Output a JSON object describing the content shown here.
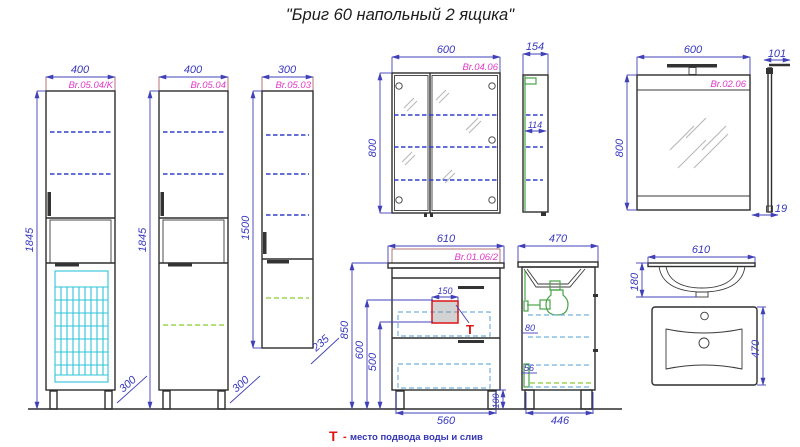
{
  "title": "\"Бриг 60 напольный 2 ящика\"",
  "legend": {
    "symbol": "Т",
    "dash": "-",
    "text": "место подвода воды и слив"
  },
  "colors": {
    "dimension": "#4040b8",
    "label": "#e03ac8",
    "outline": "#2e2e2e",
    "shelf_dashed": "#3040cc",
    "adjustable_shelf_dashed": "#b6df7e",
    "basket": "#2ec4d8",
    "drawer_dashed": "#74b2dc",
    "plumbing": "#4aa348",
    "marker": "#e01414"
  },
  "views": {
    "tall_cabinet_k": {
      "label": "Br.05.04/K",
      "width": "400",
      "height": "1845",
      "depth": "300"
    },
    "tall_cabinet": {
      "label": "Br.05.04",
      "width": "400",
      "height": "1845",
      "depth": "300"
    },
    "column_cabinet": {
      "label": "Br.05.03",
      "width": "300",
      "height": "1500",
      "depth": "235"
    },
    "mirror_cabinet": {
      "label": "Br.04.06",
      "width": "600",
      "height": "800",
      "side_depth": "154",
      "inner_depth": "114"
    },
    "mirror": {
      "label": "Br.02.06",
      "width": "600",
      "height": "800",
      "lamp_depth": "101",
      "thickness": "19"
    },
    "vanity": {
      "label": "Br.01.06/2",
      "width": "610",
      "total_height": "850",
      "supply_top": "600",
      "supply_bottom": "500",
      "cutout_width": "150",
      "base_width": "560",
      "leg_height": "100"
    },
    "vanity_side": {
      "depth": "470",
      "base_depth": "446",
      "clearance_top": "80",
      "clearance_bottom": "56"
    },
    "sink": {
      "front_width": "610",
      "bowl_depth": "180",
      "top_depth": "470"
    }
  }
}
